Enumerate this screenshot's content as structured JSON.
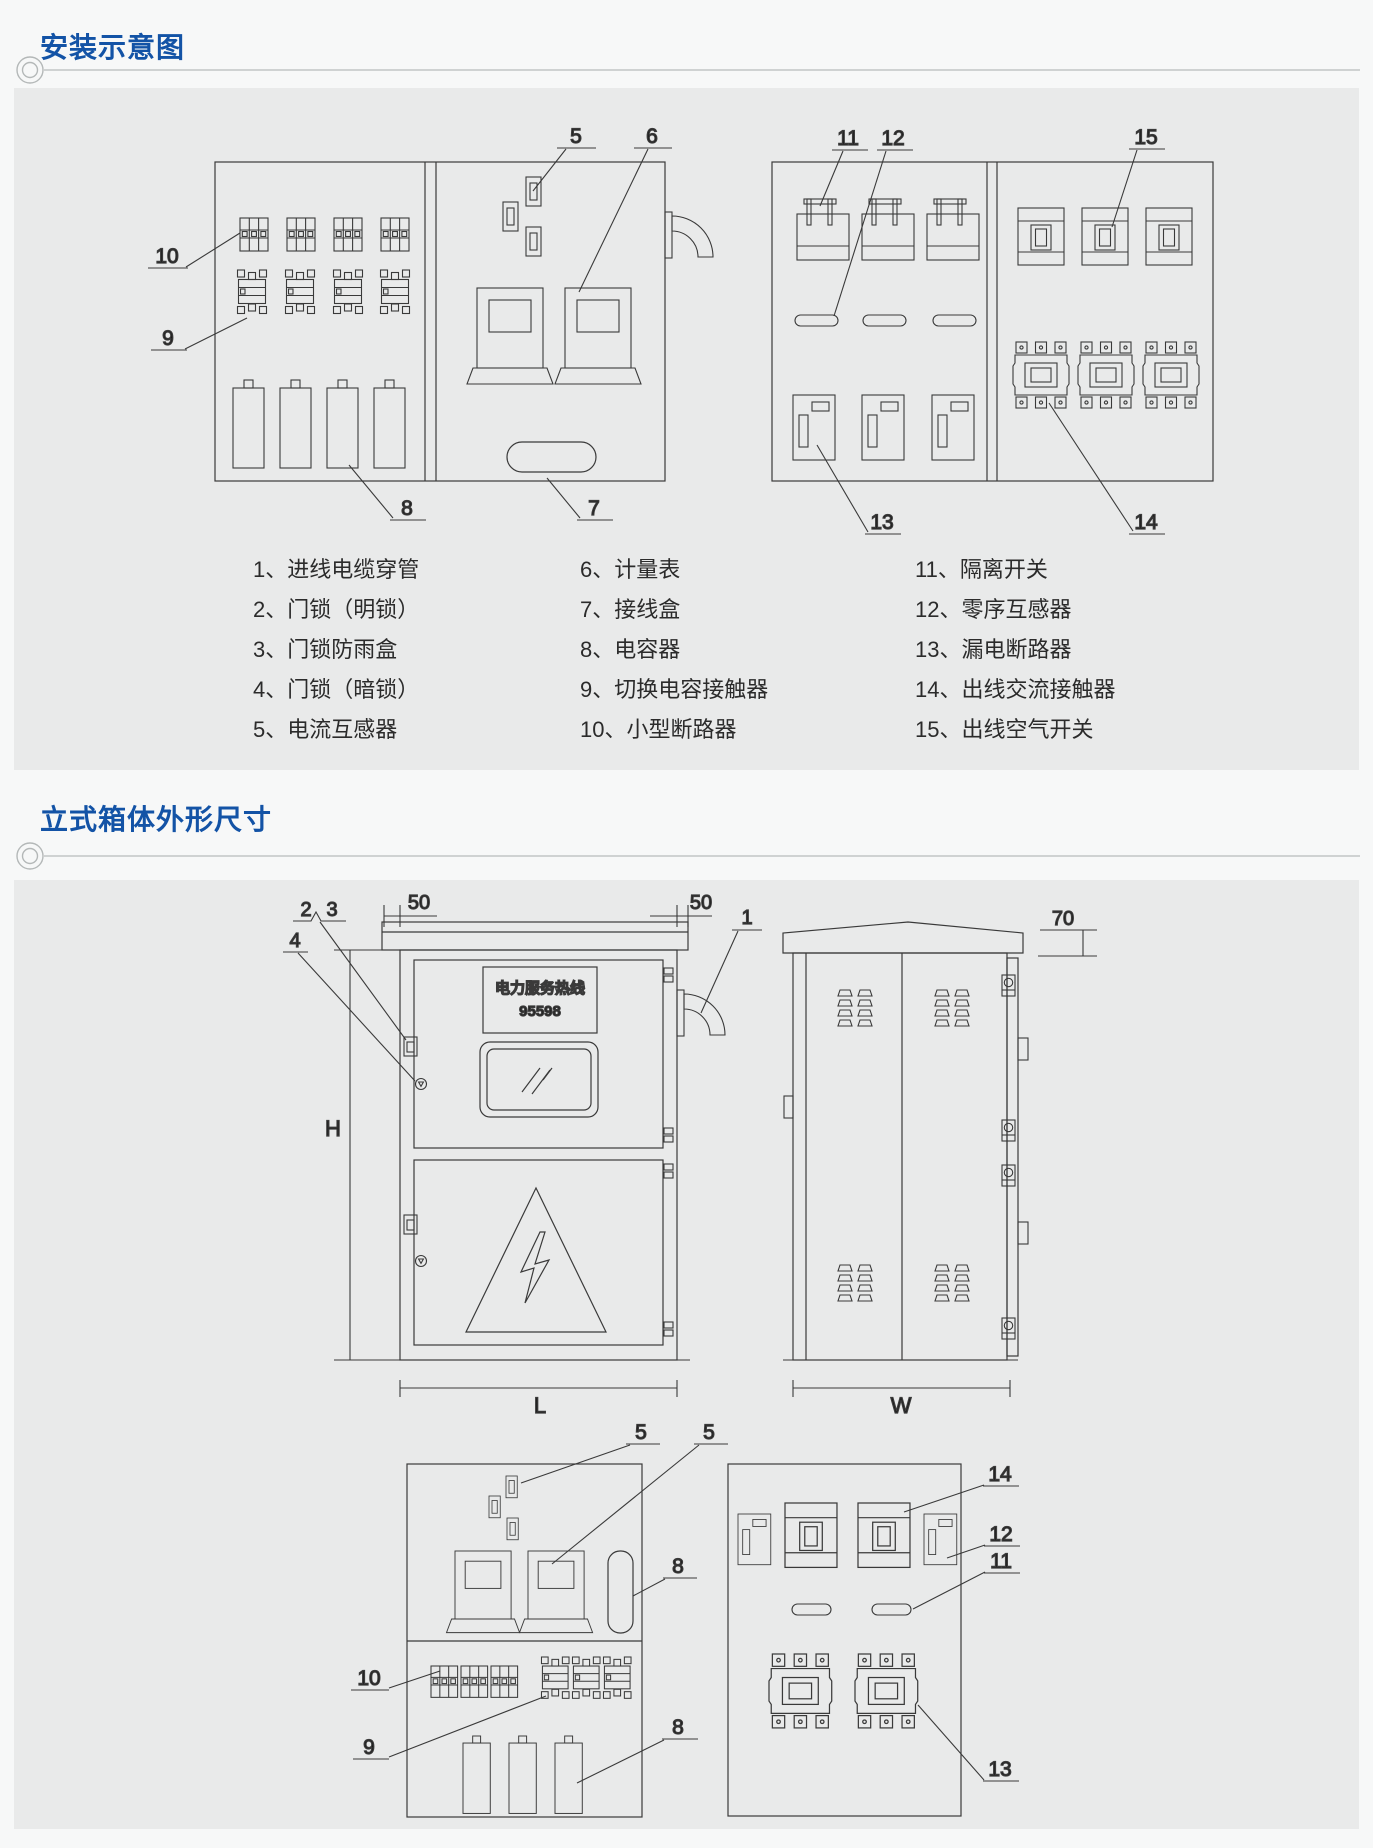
{
  "colors": {
    "accent_blue": "#1353a6",
    "panel_gray": "#e9eaea",
    "line": "#3a3a3a"
  },
  "sections": {
    "install": {
      "title": "安装示意图"
    },
    "dimensions": {
      "title": "立式箱体外形尺寸"
    }
  },
  "legend": {
    "items": [
      "1、进线电缆穿管",
      "2、门锁（明锁）",
      "3、门锁防雨盒",
      "4、门锁（暗锁）",
      "5、电流互感器",
      "6、计量表",
      "7、接线盒",
      "8、电容器",
      "9、切换电容接触器",
      "10、小型断路器",
      "11、隔离开关",
      "12、零序互感器",
      "13、漏电断路器",
      "14、出线交流接触器",
      "15、出线空气开关"
    ]
  },
  "install_diagram": {
    "left_cabinet": {
      "callouts": {
        "mcb": "10",
        "contactor": "9",
        "ct": "5",
        "meter": "6",
        "capacitor": "8",
        "junction_box": "7"
      }
    },
    "right_cabinet": {
      "callouts": {
        "isolator": "11",
        "zero_seq_ct": "12",
        "air_switch": "15",
        "leakage_breaker": "13",
        "ac_contactor": "14"
      }
    }
  },
  "dim_diagram": {
    "front": {
      "plaque": {
        "line1": "电力服务热线",
        "line2": "95598"
      },
      "dims": {
        "overhang_left": "50",
        "overhang_right": "50",
        "height": "H",
        "length": "L"
      },
      "callouts": {
        "conduit": "1",
        "lock_open": "2",
        "rain_box": "3",
        "lock_hidden": "4"
      }
    },
    "side": {
      "dims": {
        "width": "W",
        "roof": "70"
      }
    },
    "bottom_left": {
      "callouts": {
        "ct_a": "5",
        "ct_b": "5",
        "pill": "8",
        "mcb": "10",
        "contactor": "9",
        "capacitor": "8"
      }
    },
    "bottom_right": {
      "callouts": {
        "ac_contactor": "14",
        "zero_seq_ct": "12",
        "isolator": "11",
        "leakage_breaker": "13"
      }
    }
  }
}
